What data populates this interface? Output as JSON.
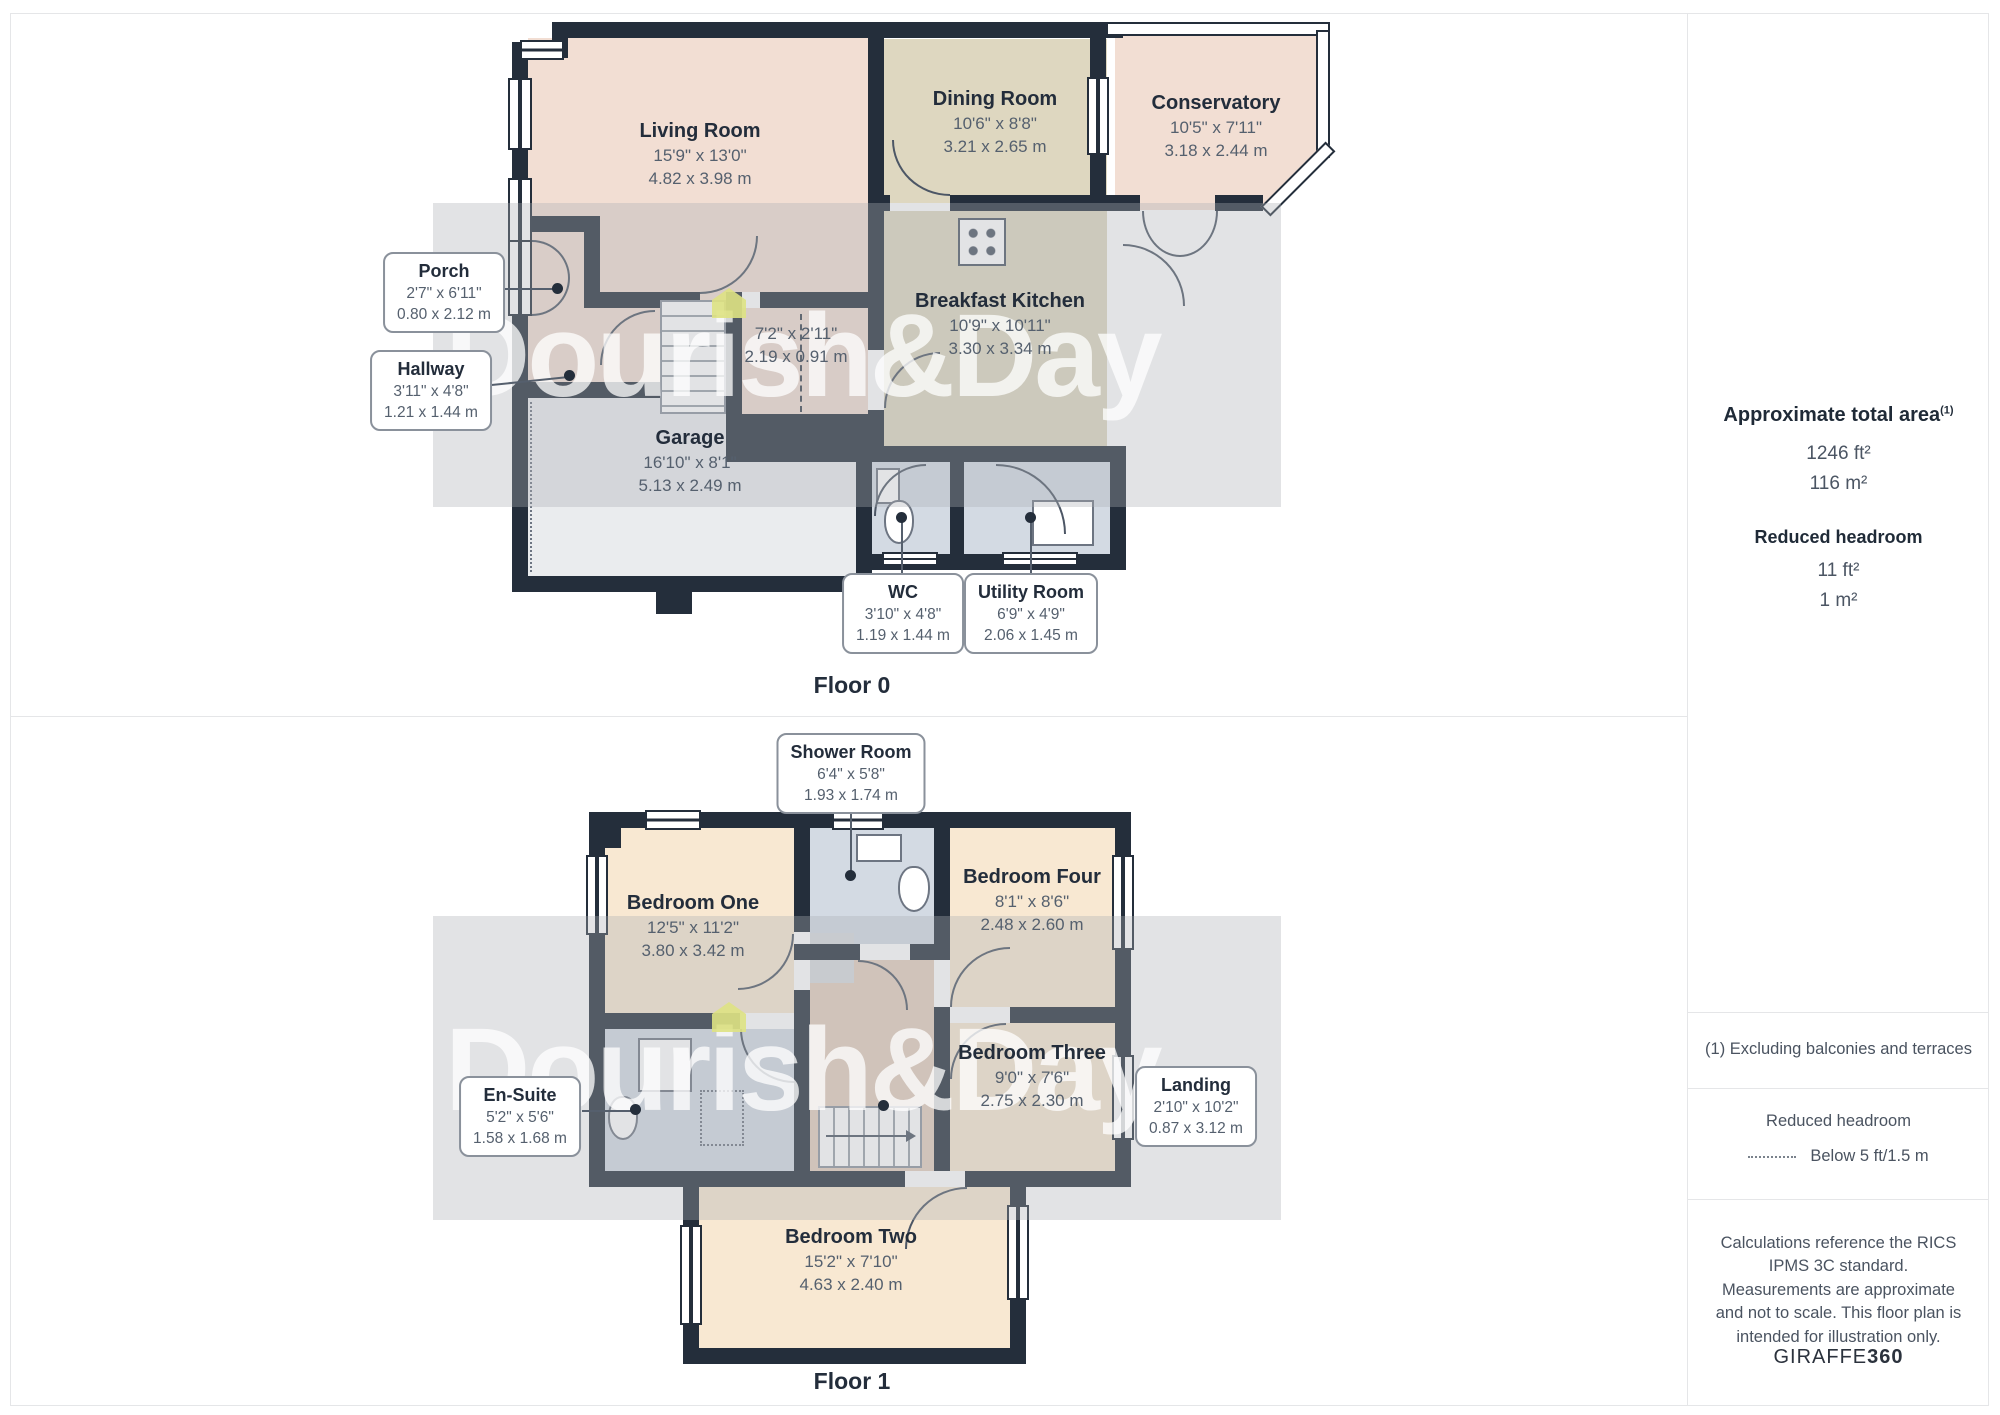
{
  "watermark": {
    "text": "Dourish&Day"
  },
  "floor0": {
    "label": "Floor 0",
    "living": {
      "name": "Living Room",
      "imperial": "15'9\" x 13'0\"",
      "metric": "4.82 x 3.98 m"
    },
    "dining": {
      "name": "Dining Room",
      "imperial": "10'6\" x 8'8\"",
      "metric": "3.21 x 2.65 m"
    },
    "conservatory": {
      "name": "Conservatory",
      "imperial": "10'5\" x 7'11\"",
      "metric": "3.18 x 2.44 m"
    },
    "kitchen": {
      "name": "Breakfast Kitchen",
      "imperial": "10'9\" x 10'11\"",
      "metric": "3.30 x 3.34 m"
    },
    "porch": {
      "name": "Porch",
      "imperial": "2'7\" x 6'11\"",
      "metric": "0.80 x 2.12 m"
    },
    "hallway": {
      "name": "Hallway",
      "imperial": "3'11\" x 4'8\"",
      "metric": "1.21 x 1.44 m"
    },
    "corridor": {
      "imperial": "7'2\" x 2'11\"",
      "metric": "2.19 x 0.91 m"
    },
    "garage": {
      "name": "Garage",
      "imperial": "16'10\" x 8'1\"",
      "metric": "5.13 x 2.49 m"
    },
    "wc": {
      "name": "WC",
      "imperial": "3'10\" x 4'8\"",
      "metric": "1.19 x 1.44 m"
    },
    "utility": {
      "name": "Utility Room",
      "imperial": "6'9\" x 4'9\"",
      "metric": "2.06 x 1.45 m"
    }
  },
  "floor1": {
    "label": "Floor 1",
    "shower": {
      "name": "Shower Room",
      "imperial": "6'4\" x 5'8\"",
      "metric": "1.93 x 1.74 m"
    },
    "bedroom1": {
      "name": "Bedroom One",
      "imperial": "12'5\" x 11'2\"",
      "metric": "3.80 x 3.42 m"
    },
    "bedroom4": {
      "name": "Bedroom Four",
      "imperial": "8'1\" x 8'6\"",
      "metric": "2.48 x 2.60 m"
    },
    "bedroom3": {
      "name": "Bedroom Three",
      "imperial": "9'0\" x 7'6\"",
      "metric": "2.75 x 2.30 m"
    },
    "bedroom2": {
      "name": "Bedroom Two",
      "imperial": "15'2\" x 7'10\"",
      "metric": "4.63 x 2.40 m"
    },
    "ensuite": {
      "name": "En-Suite",
      "imperial": "5'2\" x 5'6\"",
      "metric": "1.58 x 1.68 m"
    },
    "landing": {
      "name": "Landing",
      "imperial": "2'10\" x 10'2\"",
      "metric": "0.87 x 3.12 m"
    }
  },
  "sidebar": {
    "total_area_title": "Approximate total area",
    "total_area_footnote_marker": "(1)",
    "total_area_ft": "1246 ft²",
    "total_area_m": "116 m²",
    "reduced_headroom_title": "Reduced headroom",
    "reduced_headroom_ft": "11 ft²",
    "reduced_headroom_m": "1 m²",
    "footnote": "(1) Excluding balconies and terraces",
    "legend_title": "Reduced headroom",
    "legend_item": "Below 5 ft/1.5 m",
    "disclaimer": "Calculations reference the RICS IPMS 3C standard. Measurements are approximate and not to scale. This floor plan is intended for illustration only.",
    "brand_giraffe": "GIRAFFE",
    "brand_360": "360"
  },
  "colors": {
    "wall": "#242e3b",
    "room_pink": "#f2ded3",
    "room_khaki": "#ded7c0",
    "room_garage": "#eaecee",
    "room_wet": "#d3dae3",
    "room_peach": "#f8e8d2",
    "room_landing": "#e4cebd",
    "watermark_house": "#dee283"
  }
}
